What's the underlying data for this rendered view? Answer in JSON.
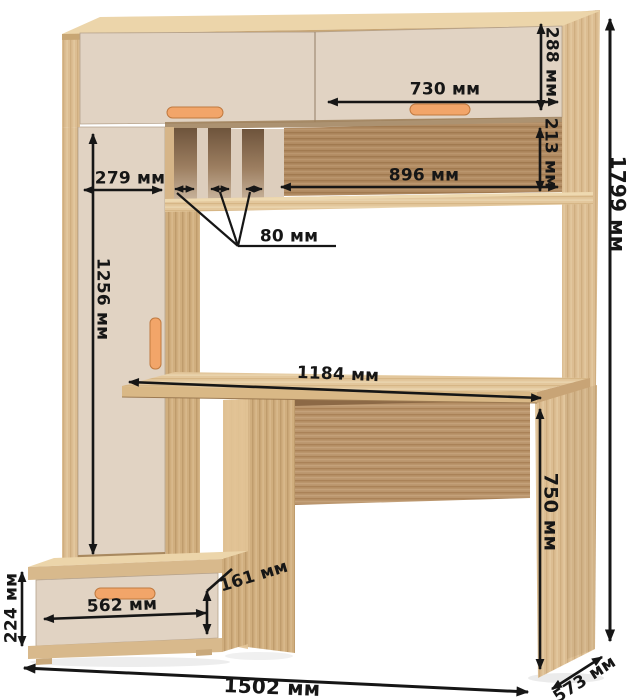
{
  "diagram": {
    "type": "furniture-dimension-diagram",
    "subject": "computer desk with hutch, tall cabinet and drawer unit",
    "units": "мм"
  },
  "dims": {
    "top_cabinet_height": "288 мм",
    "top_door_width": "730 мм",
    "shelf_height": "213 мм",
    "shelf_width": "896 мм",
    "left_door_width": "279 мм",
    "slot_width": "80 мм",
    "left_door_height": "1256 мм",
    "desktop_width": "1184 мм",
    "desk_height": "750 мм",
    "total_height": "1799 мм",
    "drawer_unit_height": "224 мм",
    "drawer_width": "562 мм",
    "drawer_front_height": "161 мм",
    "total_width": "1502 мм",
    "depth": "573 мм"
  },
  "colors": {
    "wood": "#dcbd92",
    "wood_light": "#ecd5aa",
    "wood_dark": "#b18b62",
    "cream": "#e1d3c3",
    "handle": "#f2a569",
    "ink": "#161616",
    "background": "#ffffff"
  }
}
